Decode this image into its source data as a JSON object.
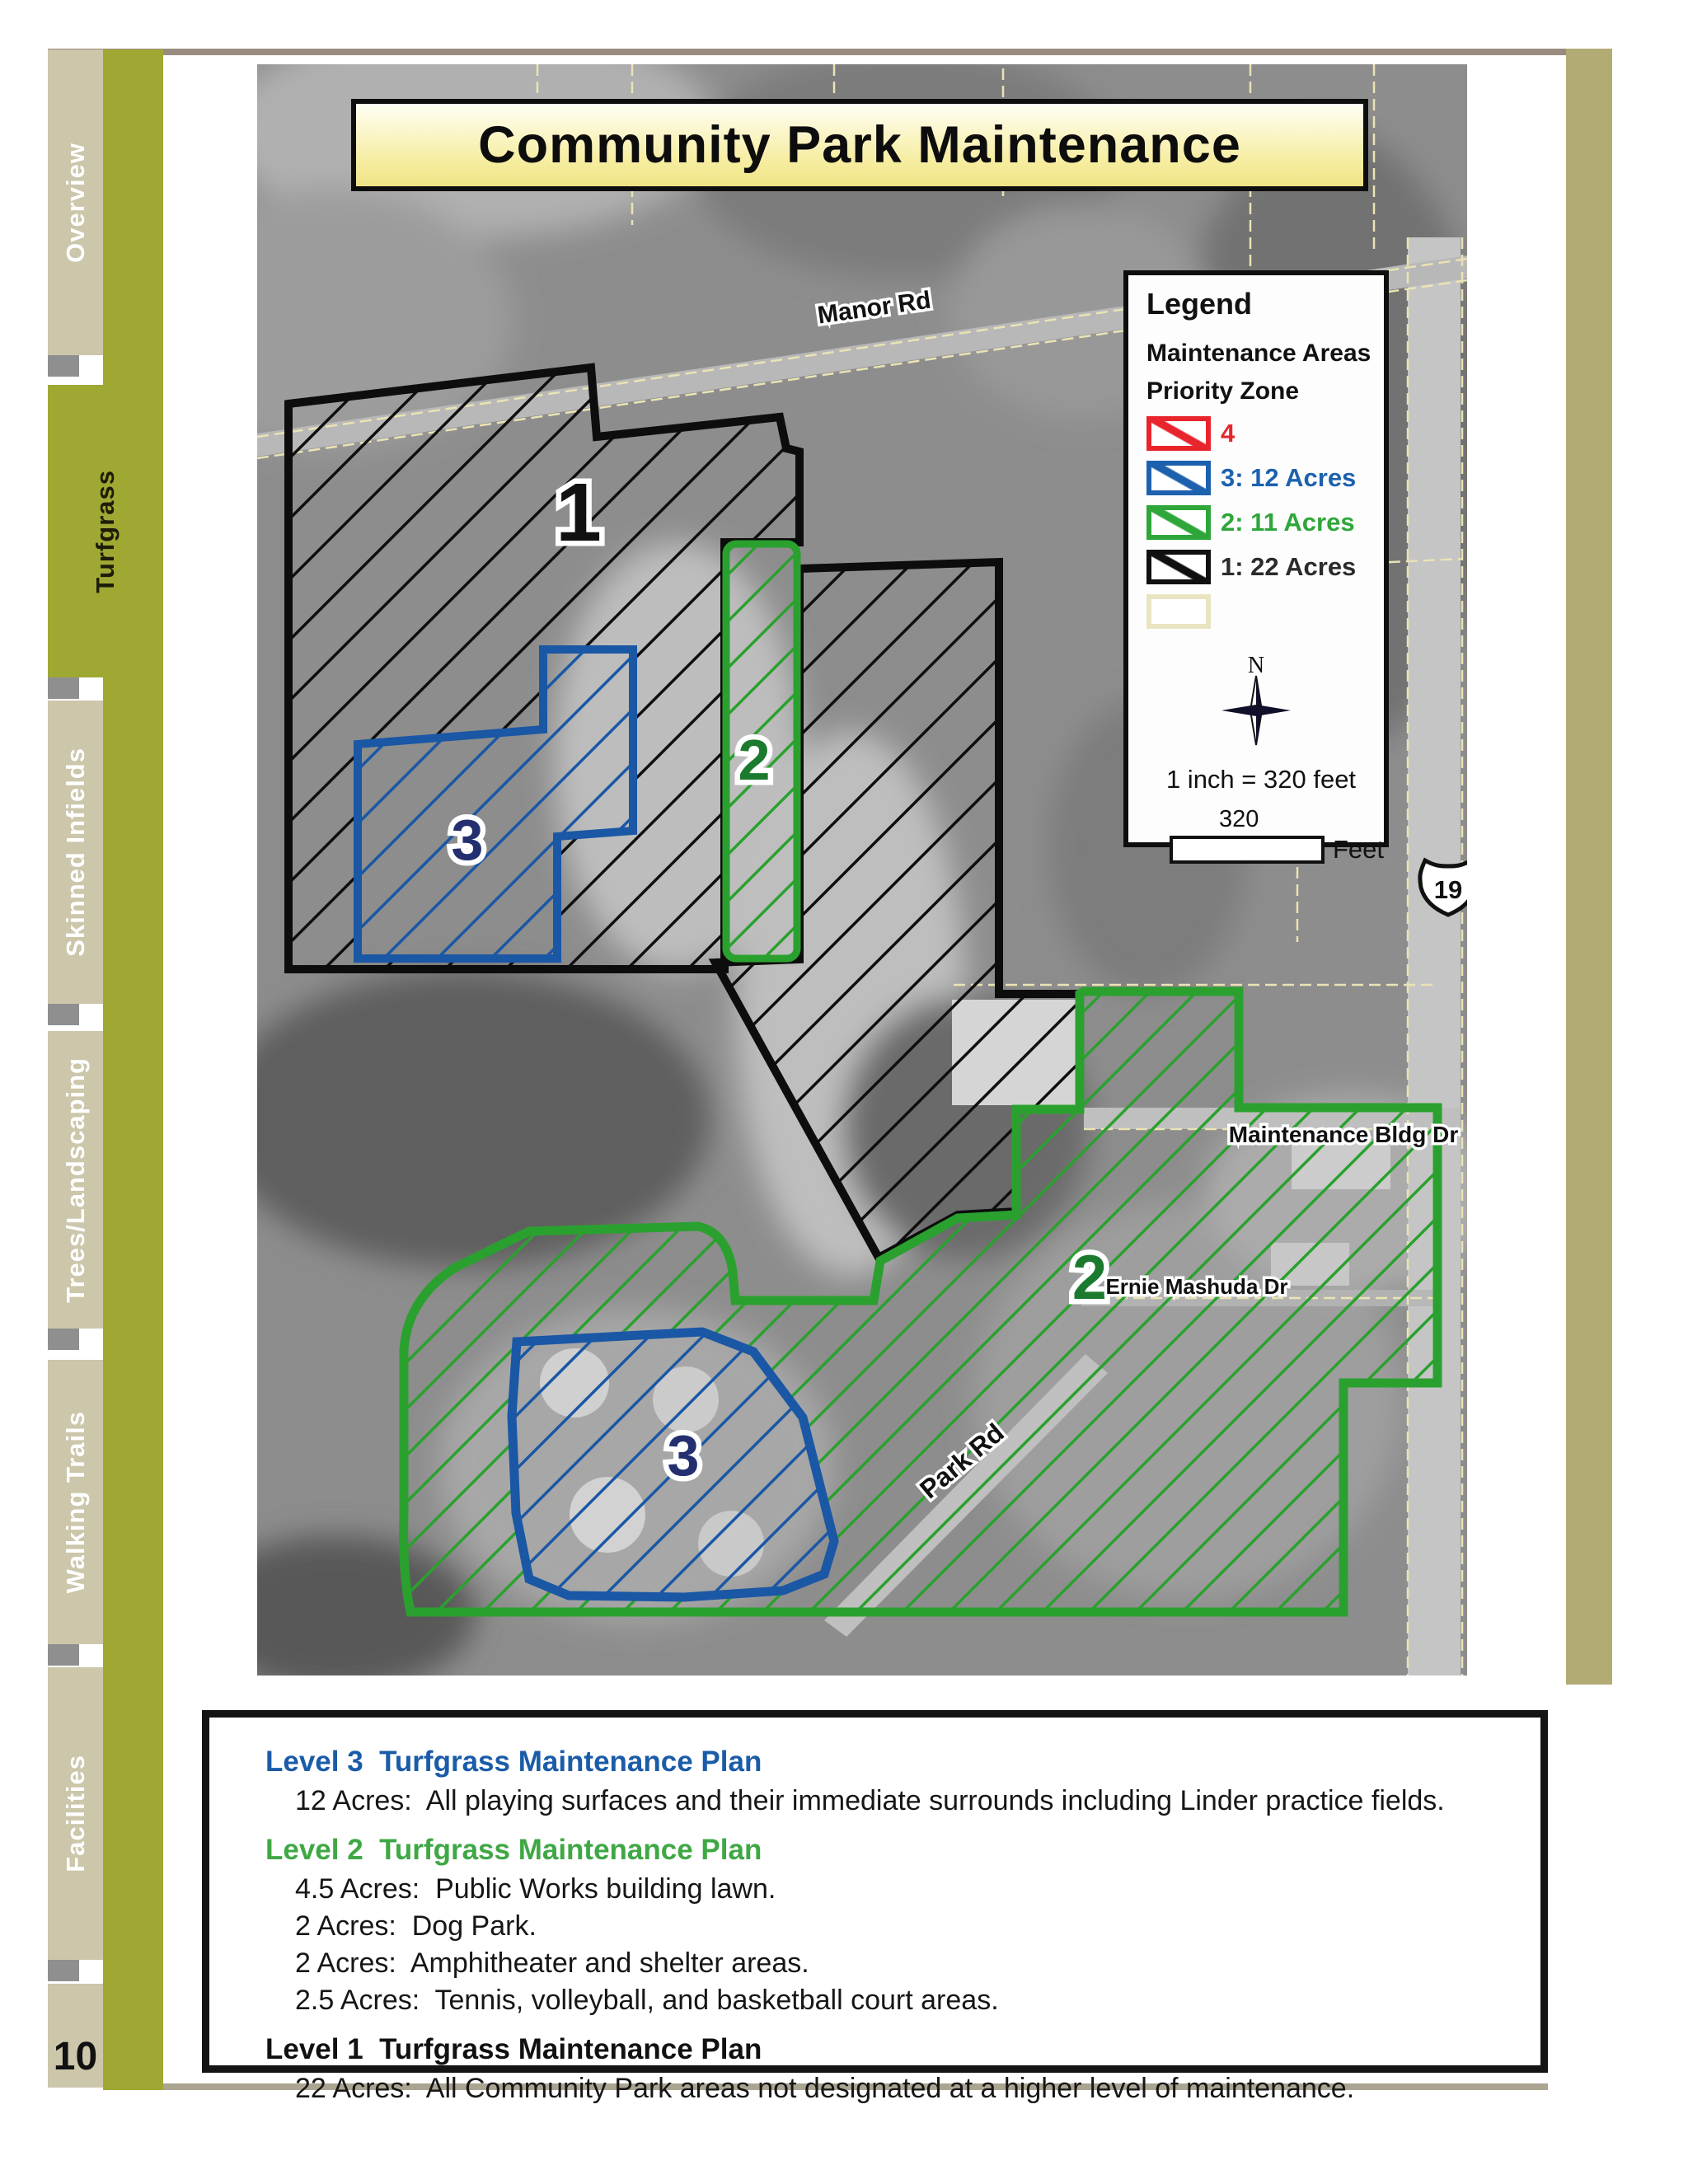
{
  "page": {
    "number": "10"
  },
  "sidebar": {
    "tabs": [
      {
        "label": "Overview",
        "active": false
      },
      {
        "label": "Turfgrass",
        "active": true
      },
      {
        "label": "Skinned Infields",
        "active": false
      },
      {
        "label": "Trees/Landscaping",
        "active": false
      },
      {
        "label": "Walking Trails",
        "active": false
      },
      {
        "label": "Facilities",
        "active": false
      }
    ],
    "colors": {
      "olive": "#9fa833",
      "tan": "#ccc6ab"
    }
  },
  "map": {
    "title": "Community Park Maintenance",
    "legend": {
      "title": "Legend",
      "subtitle": "Maintenance Areas",
      "group": "Priority Zone",
      "items": [
        {
          "label": "4",
          "color": "#e8252c"
        },
        {
          "label": "3: 12 Acres",
          "color": "#1d61ae"
        },
        {
          "label": "2: 11 Acres",
          "color": "#2fa63a"
        },
        {
          "label": "1: 22 Acres",
          "color": "#101010"
        },
        {
          "label": "",
          "color": "#e9e4c2"
        }
      ],
      "north_label": "N",
      "scale_text": "1 inch = 320 feet",
      "scale_value": "320",
      "scale_unit": "Feet"
    },
    "zones": [
      {
        "text": "1",
        "color": "#111111"
      },
      {
        "text": "2",
        "color": "#1b7a2e"
      },
      {
        "text": "3",
        "color": "#232f6e"
      },
      {
        "text": "2",
        "color": "#1b7a2e"
      },
      {
        "text": "3",
        "color": "#232f6e"
      }
    ],
    "roads": {
      "manor": "Manor Rd",
      "maintenance": "Maintenance Bldg Dr",
      "ernie": "Ernie Mashuda Dr",
      "park": "Park Rd",
      "route_shield": "19"
    }
  },
  "panel": {
    "sections": [
      {
        "heading": "Level 3  Turfgrass Maintenance Plan",
        "items": [
          "12 Acres:  All playing surfaces and their immediate surrounds including Linder practice fields."
        ]
      },
      {
        "heading": "Level 2  Turfgrass Maintenance Plan",
        "items": [
          "4.5 Acres:  Public Works building lawn.",
          "2 Acres:  Dog Park.",
          "2 Acres:  Amphitheater and shelter areas.",
          "2.5 Acres:  Tennis, volleyball, and basketball court areas."
        ]
      },
      {
        "heading": "Level 1  Turfgrass Maintenance Plan",
        "items": [
          "22 Acres:  All Community Park areas not designated at a higher level of maintenance."
        ]
      }
    ]
  }
}
